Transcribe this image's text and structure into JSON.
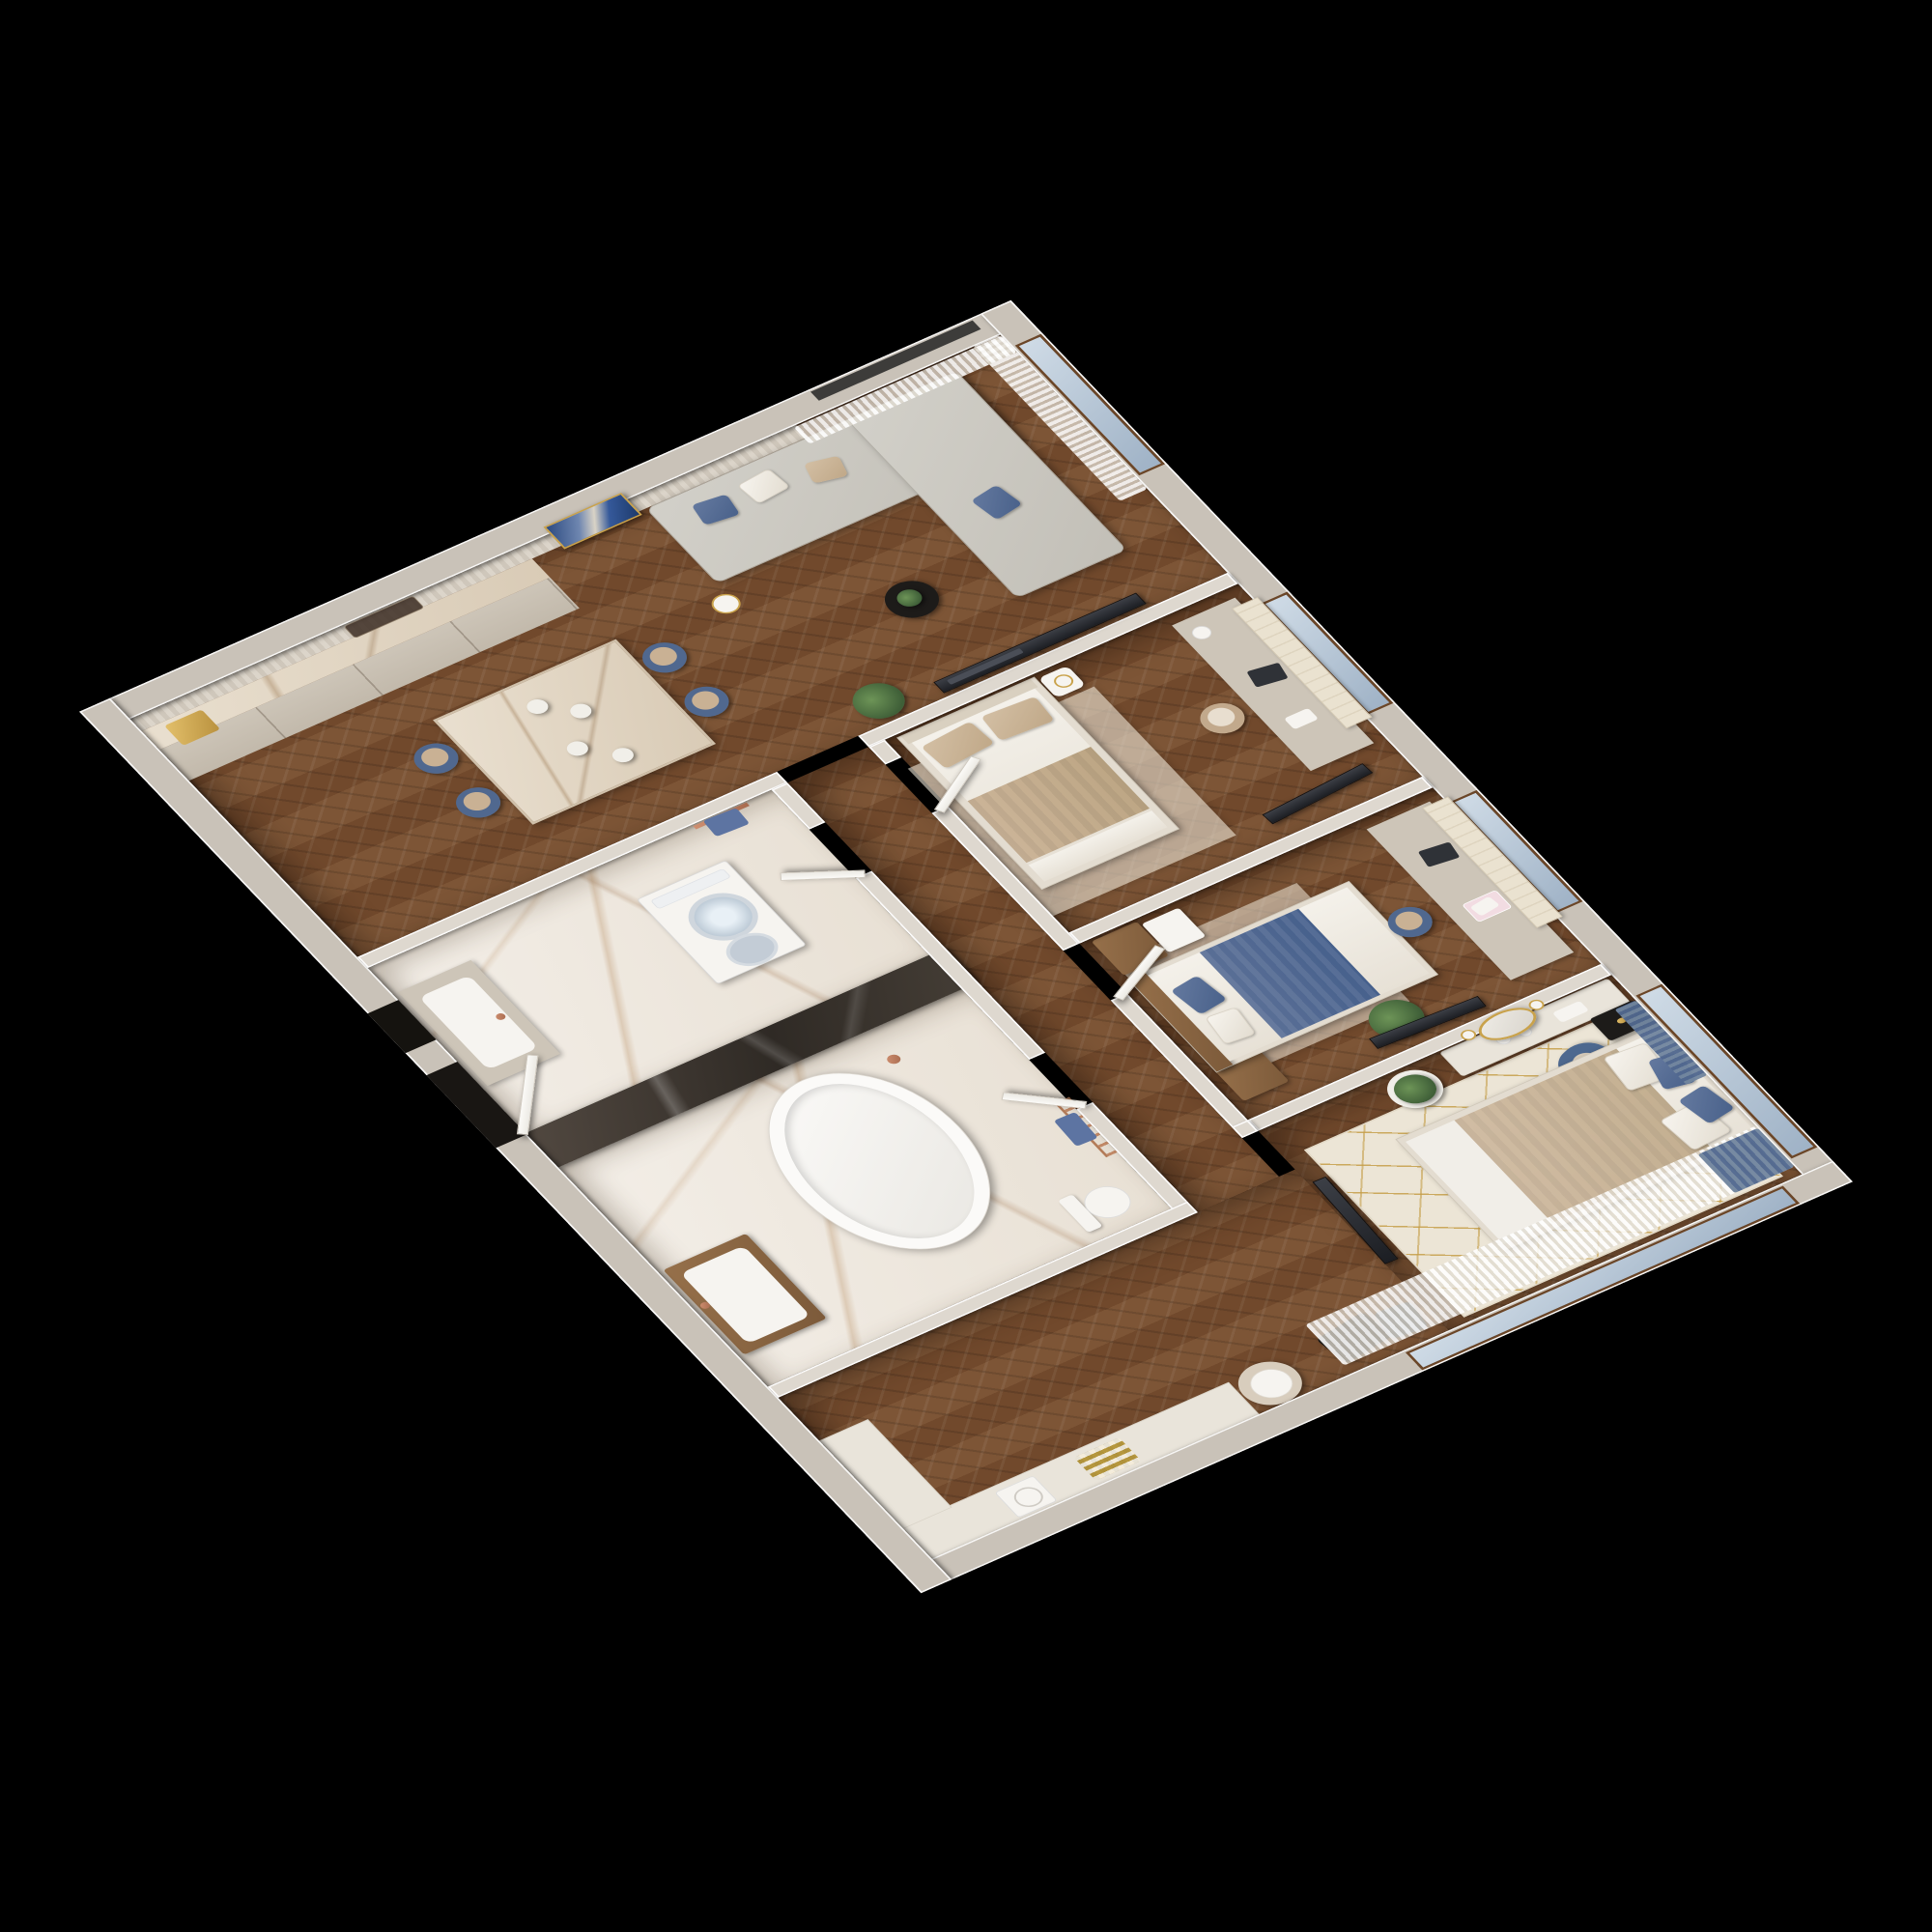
{
  "scene": {
    "type": "3d-floor-plan-cutaway-render",
    "view": "isometric from above on black background",
    "background": "#000000"
  },
  "palette": {
    "outer_wall": "#c9c2b8",
    "inner_wall": "#ded8cf",
    "wood_floor": "#7b5234",
    "marble_floor": "#efe8df",
    "counter_marble": "#e2d5c2",
    "dark_marble": "#3b342e",
    "sofa_gray": "#c9c6be",
    "accent_blue": "#50688f",
    "accent_beige": "#c9b196",
    "gold": "#c9a24b",
    "copper": "#b87b5e",
    "curtain_white": "#f2efe8",
    "window_glass": "#b9c9d9",
    "window_frame": "#6b4628",
    "tv_black": "#23252b",
    "door_white": "#f8f6f2"
  },
  "rooms": {
    "kitchen_living": {
      "label": "Open kitchen and living room",
      "floor": "herringbone wood",
      "items": [
        "fluted wall panels",
        "kitchen counter with gold sink",
        "dark glass cabinet",
        "marble island with four blue dining chairs and plates",
        "blue abstract wall art in gold frame",
        "gray corner sofa with blue and beige pillows",
        "black round side table with plant",
        "gold floor lamp",
        "wall TV on partition",
        "sheer curtains",
        "potted palm"
      ]
    },
    "bedroom_1": {
      "label": "Bedroom with beige bed and desk",
      "floor": "herringbone wood",
      "items": [
        "upholstered bed with beige bedding",
        "round white nightstand with lamp",
        "desk under window with laptop and lamp",
        "beige office chair",
        "wall TV",
        "window with roman blind"
      ]
    },
    "bedroom_2": {
      "label": "Bedroom with blue bed and vanity wall",
      "floor": "herringbone wood",
      "items": [
        "bed with wooden headboard and blue blanket",
        "wood wardrobe blocks",
        "desk under window with laptop and magazines",
        "blue office chair",
        "wall TV",
        "monstera plant",
        "window with roman blind"
      ]
    },
    "master_bedroom": {
      "label": "Master bedroom",
      "floor": "herringbone wood",
      "items": [
        "king bed with white and blue pillows",
        "cream rug with gold geometric pattern",
        "two black nightstands",
        "two blue armchairs",
        "gold floor lamp",
        "vanity console with gold oval mirror and sconces",
        "yucca plant in white pot",
        "wall TV",
        "long sheer curtains with blue drapes",
        "corner console with pouf, hat, bags and plaid scarf",
        "white vent box"
      ]
    },
    "bathroom": {
      "label": "Bathroom",
      "floor": "white marble",
      "items": [
        "freestanding white tub",
        "copper floor faucet",
        "dark marble feature wall",
        "wood vanity with white basin",
        "toilet",
        "copper towel ladder with blue towel"
      ]
    },
    "entrance_laundry": {
      "label": "Entry and laundry",
      "floor": "white marble",
      "items": [
        "stacked washer and dryer",
        "counter with white basin and copper tap",
        "copper rail with blue towel",
        "entrance door recess"
      ]
    },
    "hallway": {
      "label": "Hallway",
      "floor": "herringbone wood",
      "items": [
        "open white interior doors"
      ]
    }
  }
}
